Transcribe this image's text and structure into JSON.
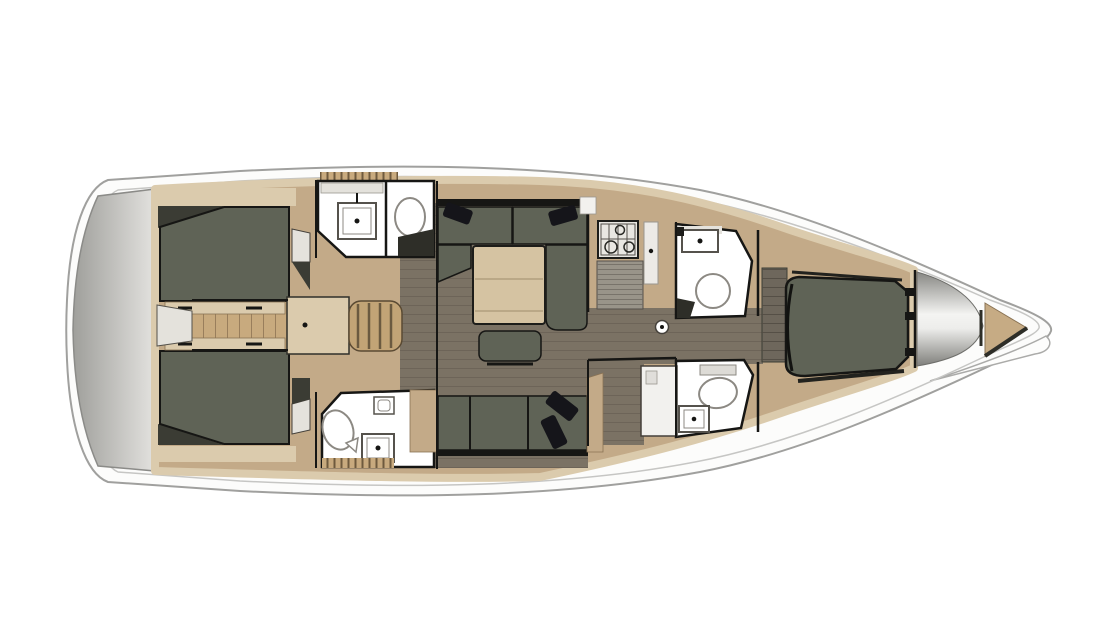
{
  "figure": {
    "kind": "sailboat-interior-deck-plan",
    "orientation": "bow-right-stern-left"
  },
  "colors": {
    "page_bg": "#ffffff",
    "deck_white": "#fcfcfb",
    "hull_stroke": "#a0a09e",
    "inner_line": "#c6c6c4",
    "transom_dark": "#a3a3a0",
    "transom_light": "#e0dfdc",
    "furniture_tan": "#c3aa88",
    "trim_tan": "#dbcbad",
    "table_tan": "#d5c3a2",
    "floor_brown": "#7b7264",
    "floor_line": "#665e52",
    "aft_wood": "#c8aa7e",
    "stair_wood": "#c2a476",
    "cushion_olive": "#5f6356",
    "shadow_olive": "#3b3c34",
    "wall_black": "#161614",
    "fixture_white": "#ffffff",
    "fixture_stroke": "#55524c",
    "seat_gray": "#e4e2dc",
    "louver_gray": "#999489",
    "bow_tan": "#c6ab84",
    "pillow_black": "#15151a"
  },
  "components": {
    "stern": [
      "transom-platform"
    ],
    "aft": [
      "aft-cabin-port",
      "aft-cabin-starboard",
      "aft-head-port",
      "aft-head-starboard",
      "companionway-steps"
    ],
    "midship": [
      "salon-u-settee",
      "salon-table",
      "salon-stool",
      "salon-settee-starboard",
      "galley-stove",
      "galley-fridge-louver",
      "mast-post"
    ],
    "forward": [
      "forward-head-port",
      "forward-head-starboard",
      "nav-station-desk",
      "forward-cabin-berth",
      "forward-dresser",
      "sail-locker",
      "bow-anchor-locker"
    ]
  }
}
